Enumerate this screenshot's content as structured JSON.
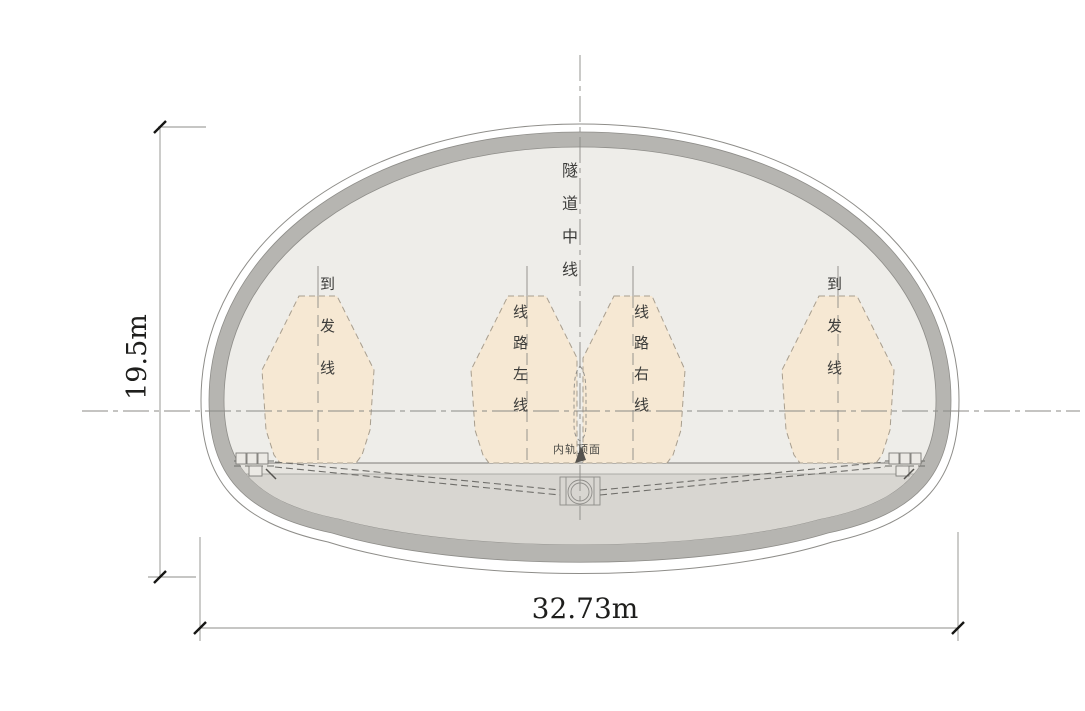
{
  "labels": {
    "tunnel_centerline": "隧道中线",
    "arrival_departure": "到发线",
    "line_left": "线路左线",
    "line_right": "线路右线",
    "rail_top_surface": "内轨顶面"
  },
  "dimensions": {
    "tunnel_height": "19.5m",
    "tunnel_width": "32.73m"
  },
  "colors": {
    "lining": "#b6b5b1",
    "interior": "#eeede9",
    "floor_strip": "#e7e5e0",
    "ballast": "#d8d6d1",
    "clearance_fill": "#f6e8d3",
    "clearance_stroke": "#a89e8e",
    "outline": "#8e8d89",
    "tick": "#161614"
  }
}
